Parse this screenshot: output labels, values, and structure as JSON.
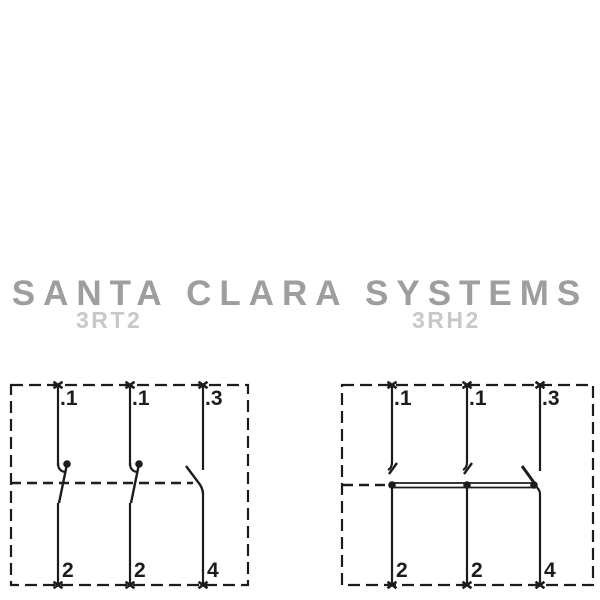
{
  "watermark": {
    "brand": "SANTA CLARA SYSTEMS",
    "left_model": "3RT2",
    "right_model": "3RH2"
  },
  "diagrams": {
    "left": {
      "model": "3RT2",
      "top_terminals": [
        ".1",
        ".1",
        ".3"
      ],
      "bottom_terminals": [
        "2",
        "2",
        "4"
      ]
    },
    "right": {
      "model": "3RH2",
      "top_terminals": [
        ".1",
        ".1",
        ".3"
      ],
      "bottom_terminals": [
        "2",
        "2",
        "4"
      ]
    }
  },
  "colors": {
    "line": "#1c1c1c",
    "background": "#ffffff",
    "watermark": "#9e9e9e",
    "model_label": "#c8c8c8"
  }
}
